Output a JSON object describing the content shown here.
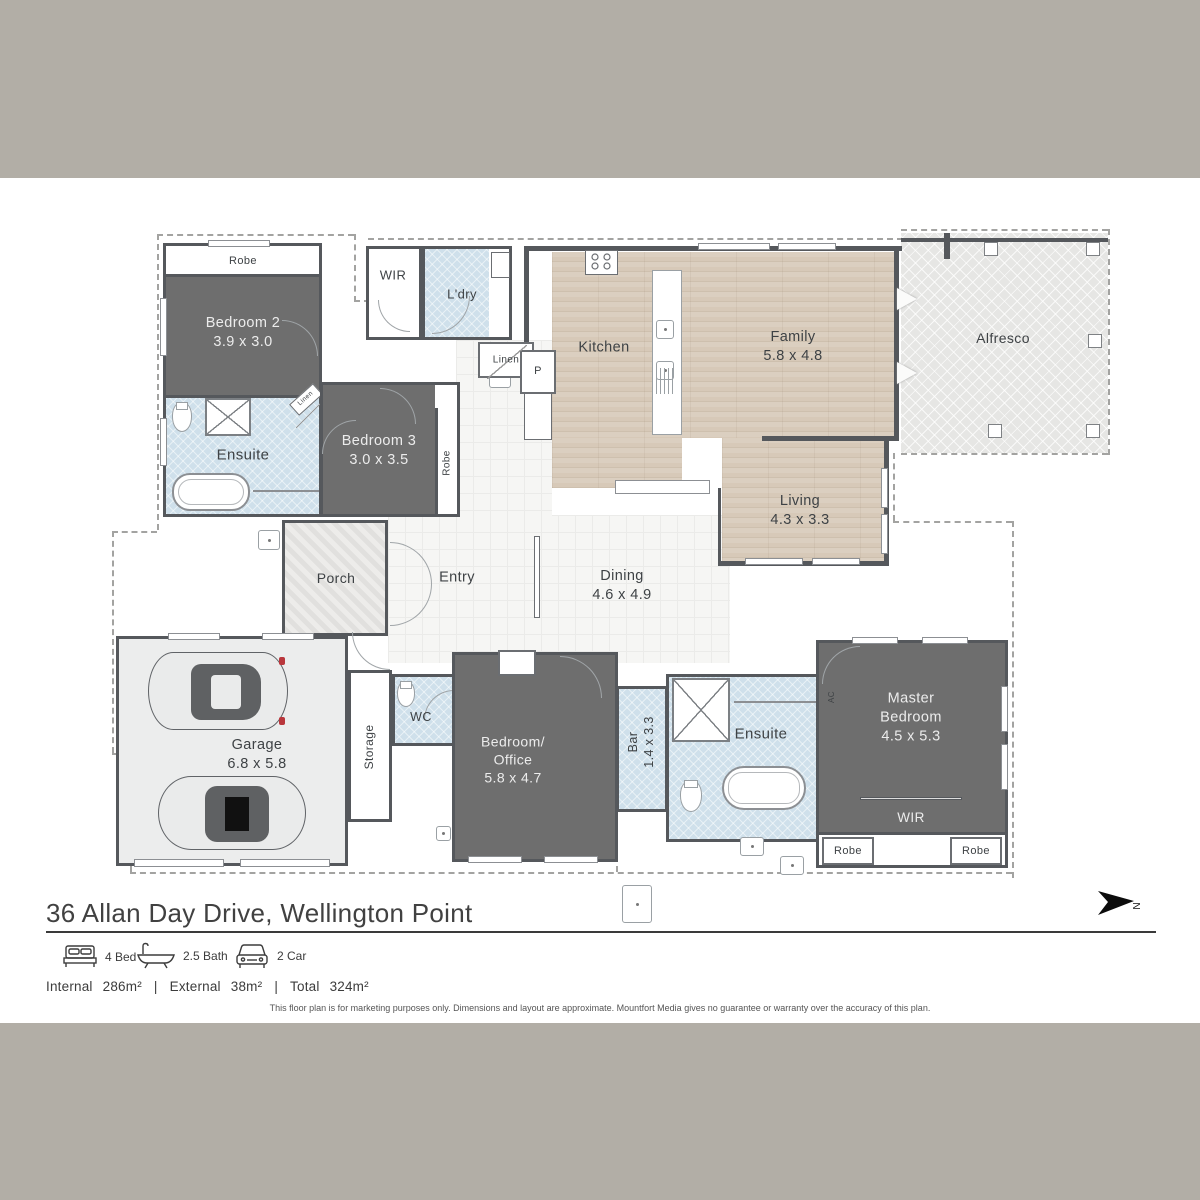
{
  "title": "36 Allan Day Drive, Wellington Point",
  "compass": {
    "n": "N"
  },
  "features": [
    {
      "icon": "bed-icon",
      "label": "4 Bed"
    },
    {
      "icon": "bath-icon",
      "label": "2.5 Bath"
    },
    {
      "icon": "car-icon",
      "label": "2 Car"
    }
  ],
  "areas": {
    "internal_label": "Internal",
    "internal_value": "286m²",
    "external_label": "External",
    "external_value": "38m²",
    "total_label": "Total",
    "total_value": "324m²",
    "sep1": "|",
    "sep2": "|"
  },
  "disclaimer": "This floor plan is for marketing purposes only. Dimensions and layout are approximate. Mountfort Media gives no guarantee or warranty over the accuracy of this plan.",
  "rooms": {
    "robe_top": {
      "name": "Robe"
    },
    "bedroom2": {
      "name": "Bedroom 2",
      "dims": "3.9 x 3.0"
    },
    "ensuite1": {
      "name": "Ensuite"
    },
    "linen_corner": {
      "name": "Linen"
    },
    "bedroom3": {
      "name": "Bedroom 3",
      "dims": "3.0 x 3.5"
    },
    "robe_b3": {
      "name": "Robe"
    },
    "wir_top": {
      "name": "WIR"
    },
    "ldry": {
      "name": "L'dry"
    },
    "linen2": {
      "name": "Linen"
    },
    "pantry": {
      "name": "P"
    },
    "kitchen": {
      "name": "Kitchen"
    },
    "family": {
      "name": "Family",
      "dims": "5.8 x 4.8"
    },
    "living": {
      "name": "Living",
      "dims": "4.3 x 3.3"
    },
    "alfresco": {
      "name": "Alfresco"
    },
    "porch": {
      "name": "Porch"
    },
    "entry": {
      "name": "Entry"
    },
    "dining": {
      "name": "Dining",
      "dims": "4.6 x 4.9"
    },
    "garage": {
      "name": "Garage",
      "dims": "6.8 x 5.8"
    },
    "storage": {
      "name": "Storage"
    },
    "wc": {
      "name": "WC"
    },
    "bedroom_office": {
      "line1": "Bedroom/",
      "line2": "Office",
      "dims": "5.8 x 4.7"
    },
    "bar": {
      "name": "Bar",
      "dims": "1.4 x 3.3"
    },
    "ensuite2": {
      "name": "Ensuite"
    },
    "ac": {
      "name": "AC"
    },
    "master": {
      "line1": "Master",
      "line2": "Bedroom",
      "dims": "4.5 x 5.3"
    },
    "wir_master": {
      "name": "WIR"
    },
    "robe_m1": {
      "name": "Robe"
    },
    "robe_m2": {
      "name": "Robe"
    }
  },
  "colors": {
    "band": "#b2aea6",
    "wall": "#55585c",
    "dark_room": "#6e6e6e",
    "wet_room": "#cfe0eb",
    "wood": "#d7c9b8",
    "outdoor_hatch": "#e6e6e4"
  }
}
